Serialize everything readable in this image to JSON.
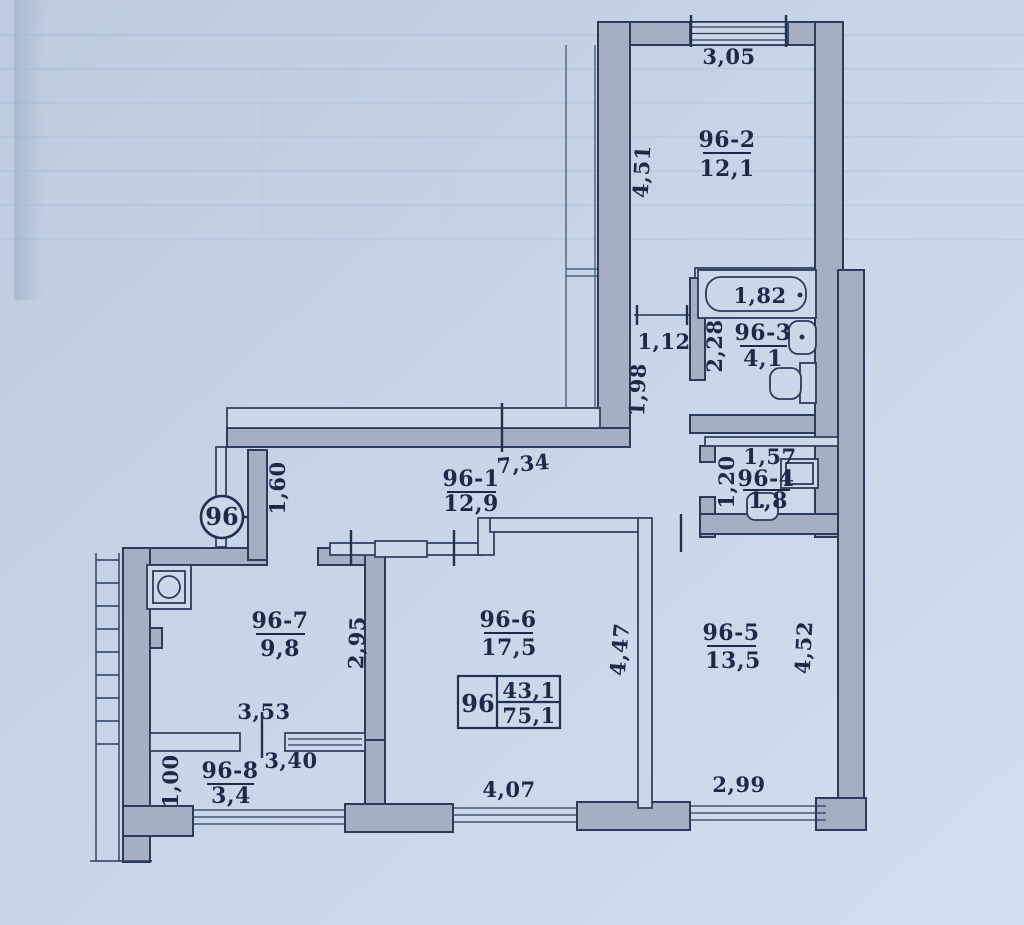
{
  "apartment": {
    "number": "96"
  },
  "summary_table": {
    "apartment_number": "96",
    "living_area": "43,1",
    "total_area": "75,1"
  },
  "rooms": {
    "r1": {
      "label": "96-1",
      "area": "12,9"
    },
    "r2": {
      "label": "96-2",
      "area": "12,1"
    },
    "r3": {
      "label": "96-3",
      "area": "4,1"
    },
    "r4": {
      "label": "96-4",
      "area": "1,8"
    },
    "r5": {
      "label": "96-5",
      "area": "13,5"
    },
    "r6": {
      "label": "96-6",
      "area": "17,5"
    },
    "r7": {
      "label": "96-7",
      "area": "9,8"
    },
    "r8": {
      "label": "96-8",
      "area": "3,4"
    }
  },
  "dimensions": {
    "top_room_width": "3,05",
    "top_room_height": "4,51",
    "bathtub": "1,82",
    "bath_height": "2,28",
    "hall_nook_width": "1,12",
    "hall_nook_height": "1,98",
    "wc_width": "1,57",
    "wc_height": "1,20",
    "corridor_length": "7,34",
    "entry_width": "1,60",
    "kitchen_height": "2,95",
    "kitchen_width": "3,53",
    "living_height": "4,47",
    "living_width": "4,07",
    "room5_height": "4,52",
    "room5_width": "2,99",
    "balcony_width": "3,40",
    "balcony_height": "1,00"
  }
}
